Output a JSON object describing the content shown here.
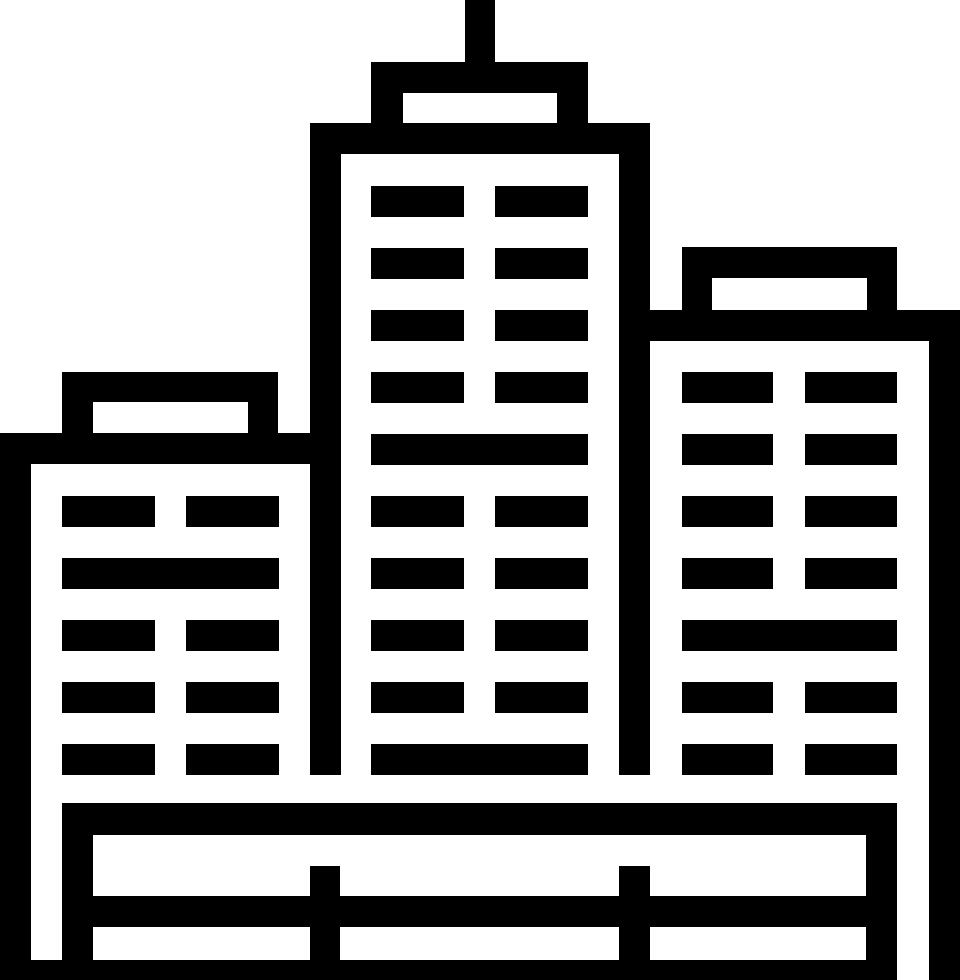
{
  "icon": {
    "name": "city-buildings",
    "description": "Black outline pictogram of a city skyline: tall center skyscraper with antenna and roof cap, shorter left building, mid-height right building, all standing on a fenced base platform",
    "foreground": "#000000",
    "background": "#ffffff",
    "canvas": {
      "width": 960,
      "height": 980
    },
    "parts": [
      {
        "name": "antenna",
        "rects": [
          [
            465,
            0,
            30,
            62
          ]
        ]
      },
      {
        "name": "center-building-roof-cap",
        "rects": [
          [
            371,
            62,
            217,
            31
          ],
          [
            371,
            93,
            32,
            31
          ],
          [
            557,
            93,
            31,
            31
          ]
        ]
      },
      {
        "name": "center-building-frame",
        "rects": [
          [
            310,
            123,
            340,
            31
          ],
          [
            310,
            123,
            31,
            652
          ],
          [
            619,
            123,
            31,
            652
          ]
        ]
      },
      {
        "name": "center-building-windows",
        "rects": [
          [
            371,
            186,
            93,
            31
          ],
          [
            495,
            186,
            93,
            31
          ],
          [
            371,
            248,
            93,
            31
          ],
          [
            495,
            248,
            93,
            31
          ],
          [
            371,
            310,
            93,
            31
          ],
          [
            495,
            310,
            93,
            31
          ],
          [
            371,
            372,
            93,
            31
          ],
          [
            495,
            372,
            93,
            31
          ],
          [
            371,
            434,
            217,
            31
          ],
          [
            371,
            496,
            93,
            31
          ],
          [
            495,
            496,
            93,
            31
          ],
          [
            371,
            558,
            93,
            31
          ],
          [
            495,
            558,
            93,
            31
          ],
          [
            371,
            620,
            93,
            31
          ],
          [
            495,
            620,
            93,
            31
          ],
          [
            371,
            682,
            93,
            31
          ],
          [
            495,
            682,
            93,
            31
          ],
          [
            371,
            744,
            217,
            31
          ]
        ]
      },
      {
        "name": "left-building-roof-cap",
        "rects": [
          [
            62,
            372,
            216,
            30
          ],
          [
            62,
            402,
            31,
            31
          ],
          [
            248,
            402,
            30,
            31
          ]
        ]
      },
      {
        "name": "left-building-frame",
        "rects": [
          [
            0,
            433,
            310,
            31
          ],
          [
            0,
            433,
            31,
            547
          ]
        ]
      },
      {
        "name": "left-building-windows",
        "rects": [
          [
            62,
            496,
            93,
            31
          ],
          [
            186,
            496,
            93,
            31
          ],
          [
            62,
            558,
            217,
            31
          ],
          [
            62,
            620,
            93,
            31
          ],
          [
            186,
            620,
            93,
            31
          ],
          [
            62,
            682,
            93,
            31
          ],
          [
            186,
            682,
            93,
            31
          ],
          [
            62,
            744,
            93,
            31
          ],
          [
            186,
            744,
            93,
            31
          ]
        ]
      },
      {
        "name": "right-building-roof-cap",
        "rects": [
          [
            682,
            247,
            215,
            31
          ],
          [
            682,
            278,
            30,
            32
          ],
          [
            867,
            278,
            30,
            32
          ]
        ]
      },
      {
        "name": "right-building-frame",
        "rects": [
          [
            650,
            310,
            310,
            31
          ],
          [
            929,
            310,
            31,
            670
          ]
        ]
      },
      {
        "name": "right-building-windows",
        "rects": [
          [
            682,
            372,
            91,
            31
          ],
          [
            805,
            372,
            92,
            31
          ],
          [
            682,
            434,
            91,
            31
          ],
          [
            805,
            434,
            92,
            31
          ],
          [
            682,
            496,
            91,
            31
          ],
          [
            805,
            496,
            92,
            31
          ],
          [
            682,
            558,
            91,
            31
          ],
          [
            805,
            558,
            92,
            31
          ],
          [
            682,
            620,
            215,
            31
          ],
          [
            682,
            682,
            91,
            31
          ],
          [
            805,
            682,
            92,
            31
          ],
          [
            682,
            744,
            91,
            31
          ],
          [
            805,
            744,
            92,
            31
          ]
        ]
      },
      {
        "name": "base-platform",
        "rects": [
          [
            62,
            803,
            835,
            32
          ],
          [
            62,
            803,
            31,
            177
          ],
          [
            866,
            803,
            31,
            177
          ],
          [
            93,
            896,
            773,
            31
          ],
          [
            310,
            866,
            30,
            114
          ],
          [
            619,
            866,
            31,
            114
          ],
          [
            0,
            960,
            897,
            20
          ]
        ]
      }
    ]
  }
}
